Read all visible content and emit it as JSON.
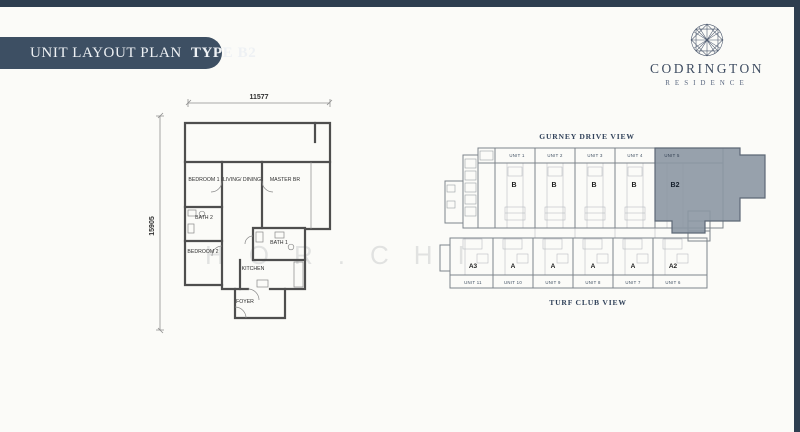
{
  "header": {
    "title": "UNIT LAYOUT PLAN",
    "type": "TYPE B2"
  },
  "brand": {
    "name": "CODRINGTON",
    "subtitle": "RESIDENCE"
  },
  "watermark": "HOR.CHI",
  "floor_plan": {
    "dims": {
      "width": "11577",
      "height": "15905"
    },
    "rooms": {
      "bedroom1": "BEDROOM 1",
      "living": "LIVING/ DINING",
      "master": "MASTER BR",
      "bath2": "BATH 2",
      "bedroom2": "BEDROOM 2",
      "bath1": "BATH 1",
      "kitchen": "KITCHEN",
      "foyer": "FOYER"
    }
  },
  "site_plan": {
    "top_view": "GURNEY DRIVE VIEW",
    "bottom_view": "TURF CLUB VIEW",
    "top_units": [
      {
        "name": "UNIT 1",
        "type": "B"
      },
      {
        "name": "UNIT 2",
        "type": "B"
      },
      {
        "name": "UNIT 3",
        "type": "B"
      },
      {
        "name": "UNIT 4",
        "type": "B"
      },
      {
        "name": "UNIT 5",
        "type": "B2",
        "highlighted": true
      }
    ],
    "bottom_units": [
      {
        "name": "UNIT 11",
        "type": "A3"
      },
      {
        "name": "UNIT 10",
        "type": "A"
      },
      {
        "name": "UNIT 9",
        "type": "A"
      },
      {
        "name": "UNIT 8",
        "type": "A"
      },
      {
        "name": "UNIT 7",
        "type": "A"
      },
      {
        "name": "UNIT 6",
        "type": "A2"
      }
    ]
  },
  "colors": {
    "navy": "#2e3e50",
    "pill": "#3d4f63",
    "highlight": "#8c97a3"
  }
}
